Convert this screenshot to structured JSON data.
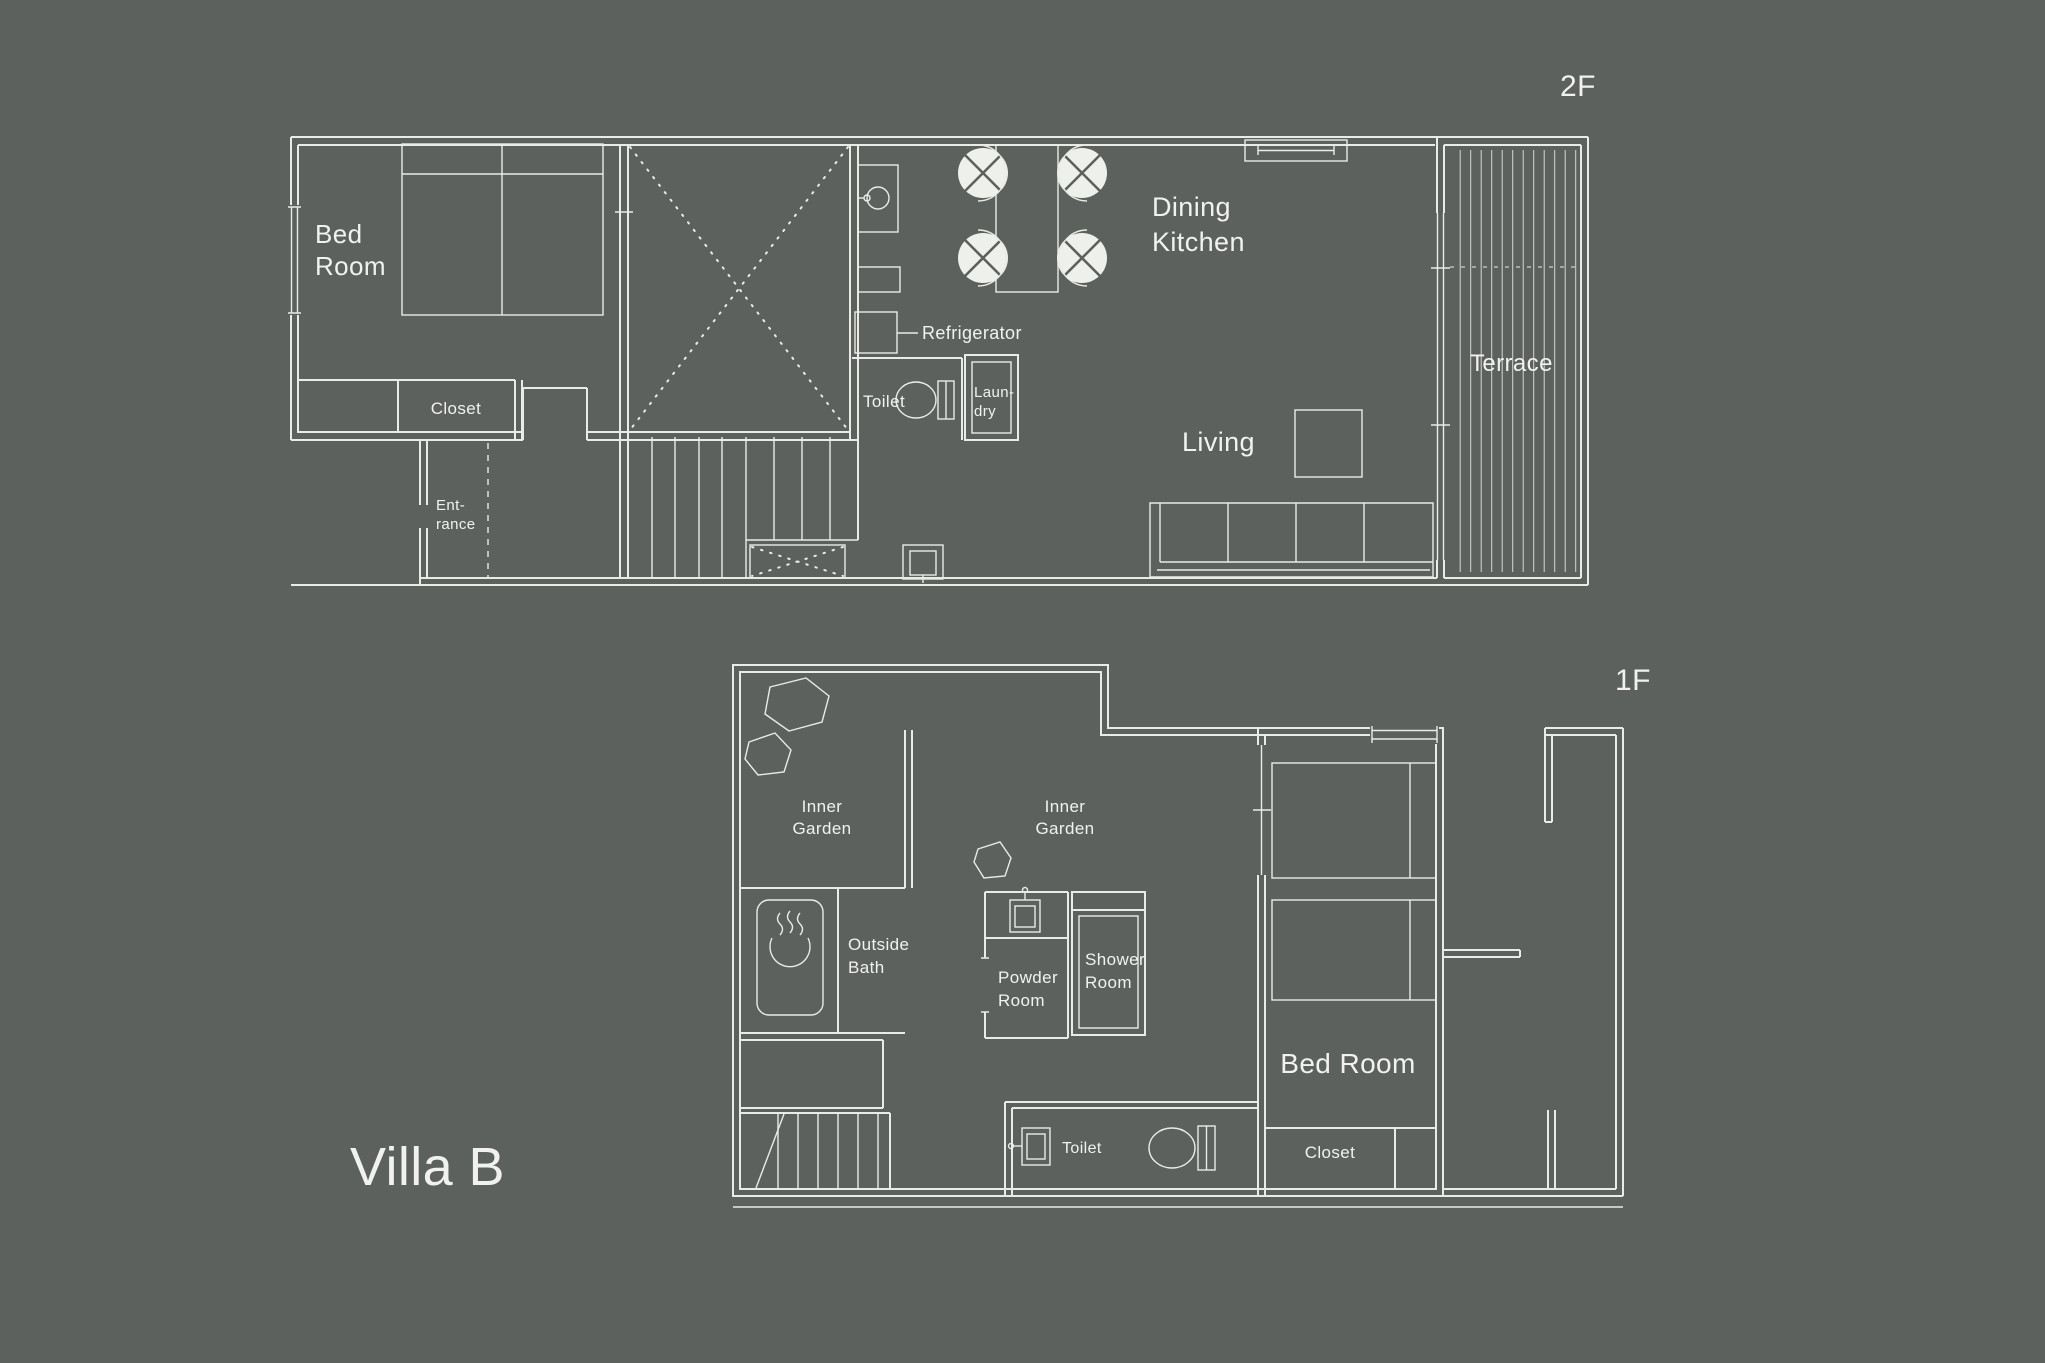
{
  "title": "Villa B",
  "colors": {
    "background": "#5d615e",
    "line": "#e9ebe7",
    "text": "#f1f2ef",
    "chair_fill": "#eef0ec"
  },
  "floors": {
    "f2": {
      "tag": "2F",
      "bed_room_l1": "Bed",
      "bed_room_l2": "Room",
      "closet": "Closet",
      "entrance_l1": "Ent-",
      "entrance_l2": "rance",
      "refrigerator": "Refrigerator",
      "toilet": "Toilet",
      "laundry_l1": "Laun-",
      "laundry_l2": "dry",
      "dining_l1": "Dining",
      "dining_l2": "Kitchen",
      "living": "Living",
      "terrace": "Terrace"
    },
    "f1": {
      "tag": "1F",
      "inner_garden1_l1": "Inner",
      "inner_garden1_l2": "Garden",
      "inner_garden2_l1": "Inner",
      "inner_garden2_l2": "Garden",
      "outside_bath_l1": "Outside",
      "outside_bath_l2": "Bath",
      "powder_l1": "Powder",
      "powder_l2": "Room",
      "shower_l1": "Shower",
      "shower_l2": "Room",
      "toilet": "Toilet",
      "bed_room": "Bed Room",
      "closet": "Closet"
    }
  }
}
